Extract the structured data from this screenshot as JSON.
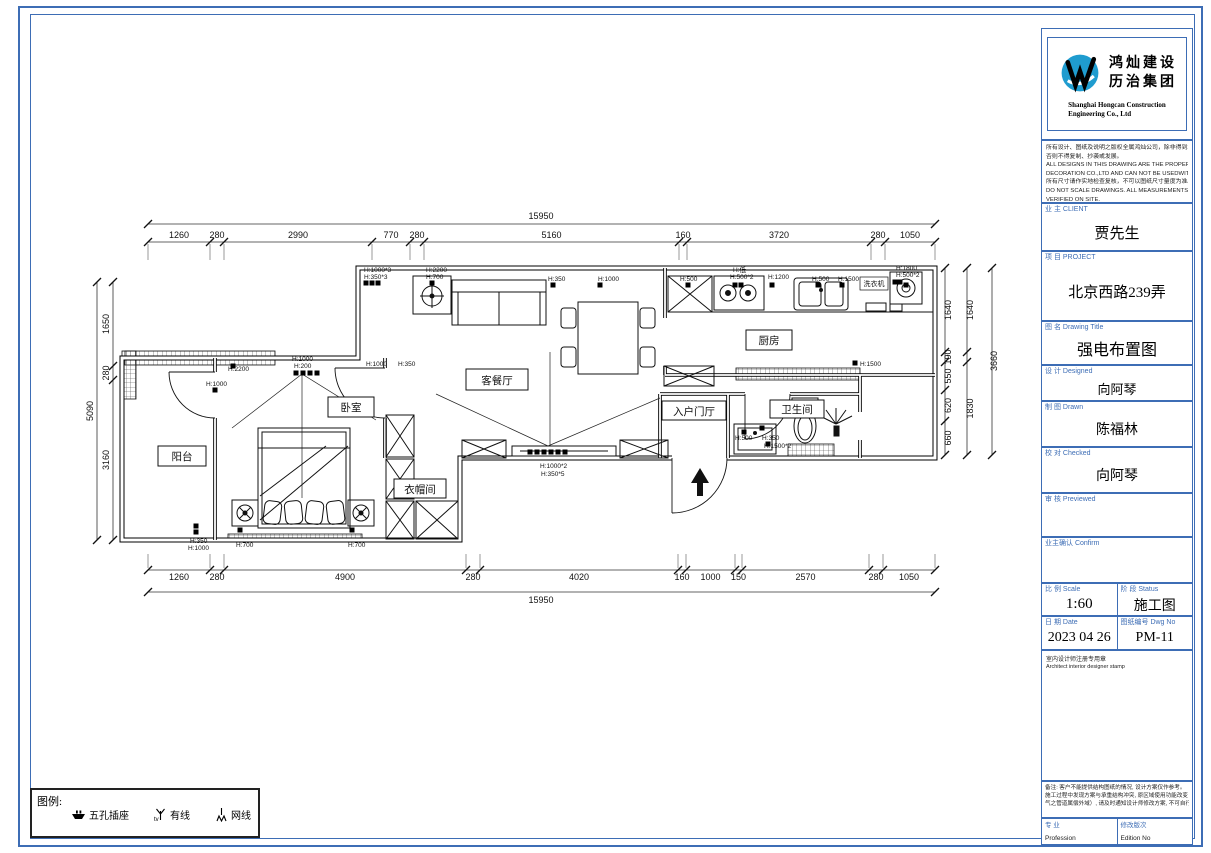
{
  "colors": {
    "frame_blue": "#3d6db5",
    "logo_blue": "#1f9ccf",
    "line_black": "#111111"
  },
  "title_block": {
    "logo": {
      "cn1": "鸿灿建设",
      "cn2": "历治集团",
      "en1": "Shanghai Hongcan Construction",
      "en2": "Engineering Co., Ltd"
    },
    "disclaimer": [
      "所有设计、图纸及说明之版权全属鸿灿公司，除非得到本公司书面同意，",
      "否则不得复制、抄袭或发展。",
      "ALL DESIGNS IN THIS DRAWING ARE THE PROPERTY OF HONG CAN",
      "DECORATION CO.,LTD AND CAN NOT BE USEDWITH",
      "所有尺寸请作实地检查复核，不可以图纸尺寸量度为准。",
      "DO NOT SCALE DRAWINGS. ALL MEASUREMENTS MUST BE CHECKED AND",
      "VERIFIED ON SITE."
    ],
    "fields": {
      "client_label": "业 主 CLIENT",
      "client_value": "贾先生",
      "project_label": "项 目 PROJECT",
      "project_value": "北京西路239弄",
      "title_label": "图 名 Drawing Title",
      "title_value": "强电布置图",
      "designed_label": "设 计 Designed",
      "designed_value": "向阿琴",
      "drawn_label": "制 图 Drawn",
      "drawn_value": "陈福林",
      "checked_label": "校 对 Checked",
      "checked_value": "向阿琴",
      "previewed_label": "审 核 Previewed",
      "previewed_value": "",
      "confirm_label": "业主确认 Confirm",
      "confirm_value": "",
      "scale_label": "比 例 Scale",
      "scale_value": "1:60",
      "status_label": "阶 段 Status",
      "status_value": "施工图",
      "date_label": "日 期 Date",
      "date_value": "2023 04 26",
      "dwg_label": "图纸编号 Dwg No",
      "dwg_value": "PM-11",
      "profession_cn": "专 业",
      "profession_en": "Profession",
      "edition_cn": "修改版次",
      "edition_en": "Edition No"
    },
    "stamp": {
      "cn": "室内设计师注册专用章",
      "en": "Architect interior designer stamp"
    },
    "remark": [
      "备注: 客户不能提供结构图纸的情况, 设计方案仅作参考。",
      "施工过程中发现方案与承重结构冲突, 原区域使用功能改变（尤其燃",
      "气之管道属偿外域）, 请及时通知设计师修改方案, 不可自行处理。"
    ]
  },
  "legend": {
    "title": "图例:",
    "items": [
      {
        "icon": "socket-icon",
        "label": "五孔插座"
      },
      {
        "icon": "tv-icon",
        "label": "有线"
      },
      {
        "icon": "lan-icon",
        "label": "网线"
      }
    ]
  },
  "plan": {
    "rooms": {
      "balcony": "阳台",
      "bedroom": "卧室",
      "living": "客餐厅",
      "foyer": "入户门厅",
      "kitchen": "厨房",
      "bath": "卫生间",
      "cloak": "衣帽间",
      "washer": "洗衣机"
    },
    "dims": {
      "top_total": "15950",
      "top_segments": [
        "1260",
        "280",
        "2990",
        "770",
        "280",
        "5160",
        "160",
        "3720",
        "280",
        "1050"
      ],
      "bottom_segments": [
        "1260",
        "280",
        "4900",
        "280",
        "4020",
        "160",
        "1000",
        "150",
        "2570",
        "280",
        "1050"
      ],
      "bottom_total": "15950",
      "left_total": "5090",
      "left_segments": [
        "1650",
        "280",
        "3160"
      ],
      "right_col1": [
        "1640",
        "190",
        "550",
        "620",
        "660"
      ],
      "right_col2": [
        "1640",
        "1830"
      ],
      "right_total": "3660"
    },
    "annotations": [
      {
        "x": 364,
        "y": 272,
        "text": "H:1000*3"
      },
      {
        "x": 364,
        "y": 279,
        "text": "H:350*3"
      },
      {
        "x": 426,
        "y": 272,
        "text": "H:2200"
      },
      {
        "x": 426,
        "y": 279,
        "text": "H:700"
      },
      {
        "x": 548,
        "y": 281,
        "text": "H:350"
      },
      {
        "x": 598,
        "y": 281,
        "text": "H:1000"
      },
      {
        "x": 680,
        "y": 281,
        "text": "H:500"
      },
      {
        "x": 733,
        "y": 272,
        "text": "H:低"
      },
      {
        "x": 730,
        "y": 279,
        "text": "H:500*2"
      },
      {
        "x": 768,
        "y": 279,
        "text": "H:1200"
      },
      {
        "x": 812,
        "y": 281,
        "text": "H:500"
      },
      {
        "x": 838,
        "y": 281,
        "text": "H:1500"
      },
      {
        "x": 896,
        "y": 270,
        "text": "H:1800"
      },
      {
        "x": 896,
        "y": 277,
        "text": "H:500*2"
      },
      {
        "x": 366,
        "y": 366,
        "text": "H:1000"
      },
      {
        "x": 398,
        "y": 366,
        "text": "H:350"
      },
      {
        "x": 292,
        "y": 361,
        "text": "H:1000"
      },
      {
        "x": 294,
        "y": 368,
        "text": "H:200"
      },
      {
        "x": 228,
        "y": 371,
        "text": "H:2200"
      },
      {
        "x": 206,
        "y": 386,
        "text": "H:1000"
      },
      {
        "x": 190,
        "y": 543,
        "text": "H:350"
      },
      {
        "x": 188,
        "y": 550,
        "text": "H:1000"
      },
      {
        "x": 236,
        "y": 547,
        "text": "H:700"
      },
      {
        "x": 348,
        "y": 547,
        "text": "H:700"
      },
      {
        "x": 540,
        "y": 468,
        "text": "H:1000*2"
      },
      {
        "x": 541,
        "y": 476,
        "text": "H:350*5"
      },
      {
        "x": 860,
        "y": 366,
        "text": "H:1500"
      },
      {
        "x": 735,
        "y": 440,
        "text": "H:500"
      },
      {
        "x": 762,
        "y": 440,
        "text": "H:350"
      },
      {
        "x": 764,
        "y": 448,
        "text": "H:1500*2"
      }
    ]
  }
}
